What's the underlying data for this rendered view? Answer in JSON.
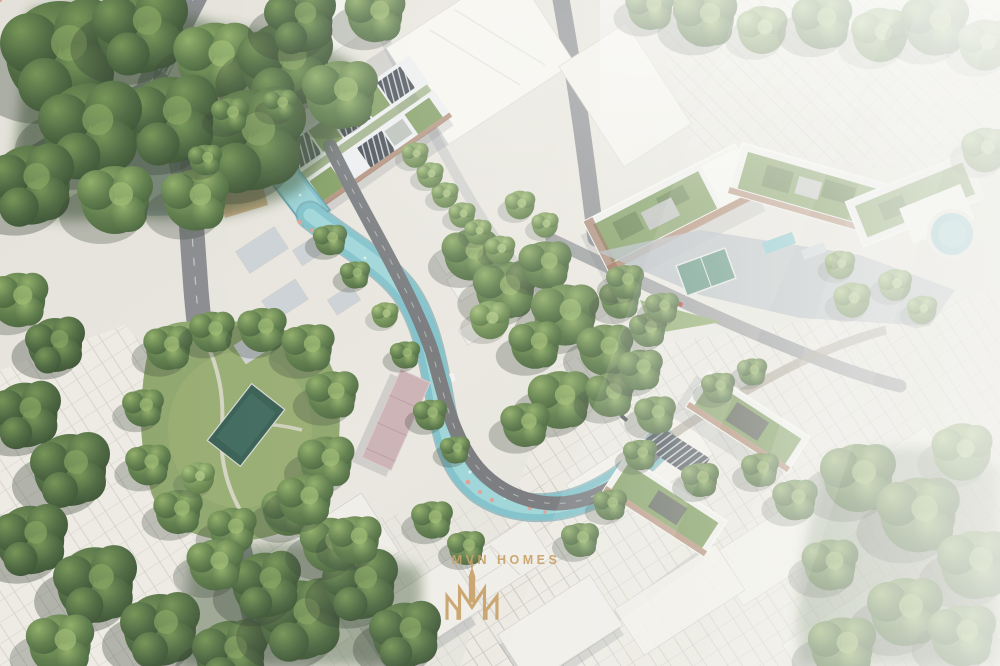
{
  "meta": {
    "title": "Aerial masterplan rendering of a riverside urban development",
    "width_px": 1000,
    "height_px": 666
  },
  "watermark": {
    "brand_name": "MVN HOMES",
    "monogram": "tower-with-double-M-emblem",
    "color": "#C8A26A"
  },
  "scene": {
    "type": "architectural-aerial-render",
    "features": [
      {
        "name": "winding-canal",
        "color": "#79BFC9"
      },
      {
        "name": "canal-basin-with-red-footbridge",
        "bridge_color": "#BF4036"
      },
      {
        "name": "riverside-road"
      },
      {
        "name": "mixed-use-complex-green-solar-roofs"
      },
      {
        "name": "bright-white-massing-buildings"
      },
      {
        "name": "top-right-residential-cluster-green-roofs"
      },
      {
        "name": "lower-right-residential-cluster-green-roofs"
      },
      {
        "name": "pink-roof-building",
        "color": "#C9AEB2"
      },
      {
        "name": "neighborhood-park-with-pool",
        "pool_color": "#2E584C"
      },
      {
        "name": "courtyard-plaza-with-sports-court",
        "court_color": "#5D9181"
      },
      {
        "name": "circular-pond",
        "color": "#8CC6CE"
      },
      {
        "name": "dense-tree-canopy",
        "color": "#47633B"
      },
      {
        "name": "white-city-fabric-with-parcel-lines"
      },
      {
        "name": "fog-haze-on-right"
      }
    ]
  },
  "palette": {
    "base": "#E6E4DD",
    "water": "#79BFC9",
    "water_light": "#9FD7DA",
    "tree_dark": "#2F4729",
    "tree_mid": "#587845",
    "lawn": "#8AA368",
    "road": "#84878B",
    "road_dark": "#6F7276",
    "plaza": "#AEB6BD",
    "building_white": "#F6F5F0",
    "green_roof": "#7D9B5E",
    "solar_roof": "#39414A",
    "terracotta": "#9C6B4F",
    "coral_accent": "#E09A8E",
    "gold": "#C8A26A"
  }
}
